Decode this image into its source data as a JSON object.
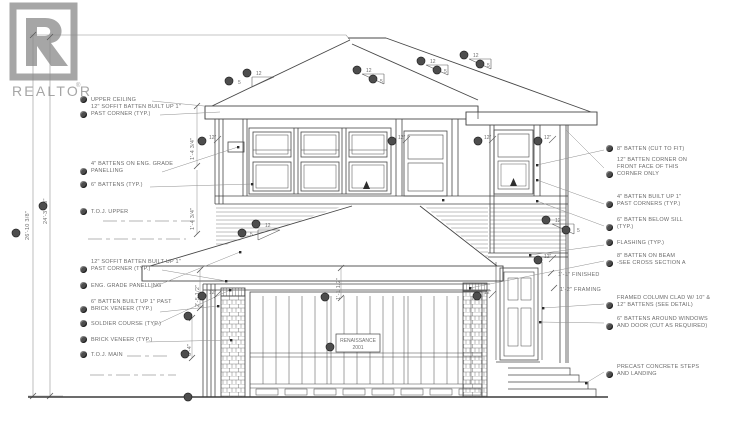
{
  "logo": {
    "brand": "REALTOR",
    "registered": "®"
  },
  "left_labels": [
    {
      "text": "UPPER CEILING"
    },
    {
      "text": "12\" SOFFIT BATTEN BUILT UP 1\"\nPAST CORNER (TYP.)"
    },
    {
      "text": "4\" BATTENS ON ENG. GRADE\nPANELLING"
    },
    {
      "text": "6\" BATTENS (TYP.)"
    },
    {
      "text": "T.O.J. UPPER"
    },
    {
      "text": "12\" SOFFIT BATTEN BUILT UP 1\"\nPAST CORNER (TYP.)"
    },
    {
      "text": "ENG. GRADE PANELLING"
    },
    {
      "text": "6\" BATTEN BUILT UP 1\" PAST\nBRICK VENEER (TYP.)"
    },
    {
      "text": "SOLDIER COURSE (TYP.)"
    },
    {
      "text": "BRICK VENEER (TYP.)"
    },
    {
      "text": "T.O.J. MAIN"
    }
  ],
  "right_labels": [
    {
      "text": "8\" BATTEN (CUT TO FIT)"
    },
    {
      "text": "12\" BATTEN CORNER ON\nFRONT FACE OF THIS\nCORNER ONLY"
    },
    {
      "text": "4\" BATTEN BUILT UP 1\"\nPAST CORNERS (TYP.)"
    },
    {
      "text": "6\" BATTEN BELOW SILL\n(TYP.)"
    },
    {
      "text": "FLASHING (TYP.)"
    },
    {
      "text": "8\" BATTEN ON BEAM\n-SEE CROSS SECTION A"
    },
    {
      "text": "FRAMED COLUMN CLAD W/ 10\" &\n12\" BATTENS (SEE DETAIL)"
    },
    {
      "text": "6\" BATTENS AROUND WINDOWS\nAND DOOR (CUT AS REQUIRED)"
    },
    {
      "text": "PRECAST CONCRETE STEPS\nAND LANDING"
    }
  ],
  "drawing": {
    "plate_line1": "RENAISSANCE",
    "plate_line2": "2001",
    "slope_rise": "12",
    "slope_run": "5",
    "soffit_offset": "12\"",
    "dim_overall": "26'-10 3/8\"",
    "dim_wall": "24'-3 3/8\"",
    "dim_upper_band": "1'-4 3/4\"",
    "dim_mid_band": "2'-5 1/2\"",
    "dim_brick": "6'-4\"",
    "dim_garage_fascia": "1'-1 1/2\"",
    "dim_finished": "1'-1\" FINISHED",
    "dim_framing": "1'-2\" FRAMING"
  },
  "colors": {
    "line": "#474747",
    "text": "#6e6e6e",
    "logo": "#a6a6a6",
    "keynote": "#4d4d4d"
  }
}
